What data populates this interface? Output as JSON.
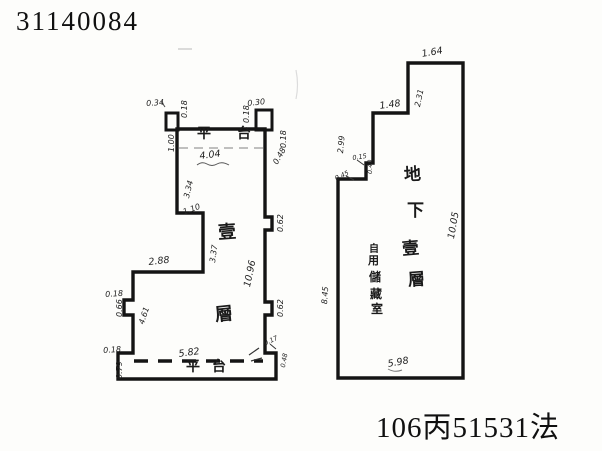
{
  "page": {
    "doc_number": "31140084",
    "ref_number": "106丙51531法",
    "ink_color": "#151515",
    "paper_color": "#fdfdfb"
  },
  "left_plan": {
    "title_semantic": "first-floor plan",
    "platform_top": "平台",
    "platform_bottom": "平台",
    "floor_label": {
      "char1": "壹",
      "char2": "層"
    },
    "dims": [
      {
        "text": "0.34"
      },
      {
        "text": "0.18"
      },
      {
        "text": "1.00"
      },
      {
        "text": "4.04"
      },
      {
        "text": "3.34"
      },
      {
        "text": "1.10"
      },
      {
        "text": "3.37"
      },
      {
        "text": "2.88"
      },
      {
        "text": "10.96"
      },
      {
        "text": "0.62"
      },
      {
        "text": "0.62"
      },
      {
        "text": "0.30"
      },
      {
        "text": "0.18"
      },
      {
        "text": "0.18"
      },
      {
        "text": "0.48"
      },
      {
        "text": "0.18"
      },
      {
        "text": "0.66"
      },
      {
        "text": "4.61"
      },
      {
        "text": "0.18"
      },
      {
        "text": "0.79"
      },
      {
        "text": "5.82"
      },
      {
        "text": "0.17"
      },
      {
        "text": "0.48"
      }
    ]
  },
  "right_plan": {
    "title_semantic": "basement plan",
    "room_label": {
      "char1": "地",
      "char2": "下",
      "char3": "壹",
      "char4": "層"
    },
    "use_label": {
      "char1": "自",
      "char2": "用",
      "char3": "儲",
      "char4": "藏",
      "char5": "室"
    },
    "dims": [
      {
        "text": "1.64"
      },
      {
        "text": "2.31"
      },
      {
        "text": "1.48"
      },
      {
        "text": "2.99"
      },
      {
        "text": "0.15"
      },
      {
        "text": "0.40"
      },
      {
        "text": "0.45"
      },
      {
        "text": "8.45"
      },
      {
        "text": "10.05"
      },
      {
        "text": "5.98"
      }
    ]
  }
}
